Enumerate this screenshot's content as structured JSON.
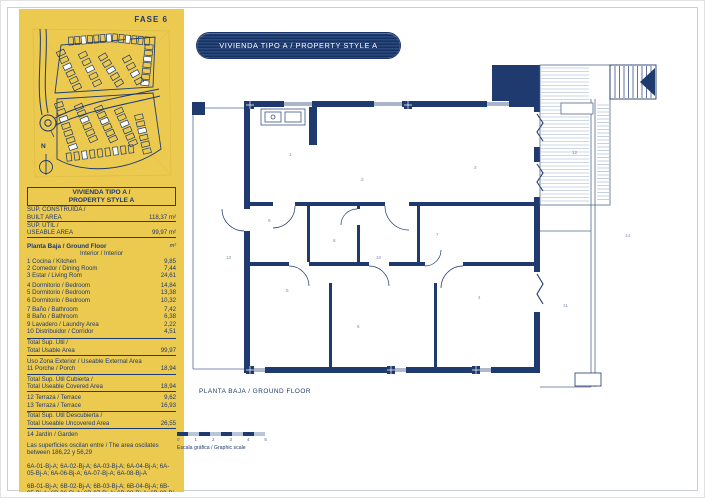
{
  "colors": {
    "navy": "#1f3a6e",
    "yellow": "#ecc94f",
    "deck_line": "#8fa3c4"
  },
  "sidebar": {
    "phase_label": "FASE 6",
    "north_label": "N",
    "table": {
      "title_line1": "VIVIENDA TIPO A /",
      "title_line2": "PROPERTY STYLE A",
      "area_rows": [
        {
          "label": "SUP. CONSTRUÍDA /",
          "value": ""
        },
        {
          "label": "BUILT AREA",
          "value": "118,37 m²"
        },
        {
          "label": "SUP. ÚTIL /",
          "value": ""
        },
        {
          "label": "USEABLE AREA",
          "value": "99,97 m²"
        }
      ],
      "floor_header": {
        "label": "Planta Baja / Ground Floor",
        "unit": "m²"
      },
      "interior_header": "Interior / Interior",
      "interior_rows": [
        {
          "label": "1 Cocina / Kitchen",
          "value": "9,85"
        },
        {
          "label": "2 Comedor / Dining Room",
          "value": "7,44"
        },
        {
          "label": "3 Estar / Living Rom",
          "value": "24,61"
        },
        {
          "label": "4 Dormitorio / Bedroom",
          "value": "14,84"
        },
        {
          "label": "5 Dormitorio / Bedroom",
          "value": "13,38"
        },
        {
          "label": "6 Dormitorio / Bedroom",
          "value": "10,32"
        },
        {
          "label": "7 Baño / Bathroom",
          "value": "7,42"
        },
        {
          "label": "8 Baño / Bathroom",
          "value": "6,38"
        },
        {
          "label": "9 Lavadero / Laundry Area",
          "value": "2,22"
        },
        {
          "label": "10 Distribuidor / Corridor",
          "value": "4,51"
        }
      ],
      "total_usable": {
        "label1": "Total Sup. Útil /",
        "label2": "Total Usable Area",
        "value": "99,97"
      },
      "external_header": "Uso Zona Exterior / Useable External Area",
      "porch_row": {
        "label": "11 Porche / Porch",
        "value": "18,94"
      },
      "total_covered": {
        "label1": "Total Sup. Útil Cubierta /",
        "label2": "Total Useable Covered Area",
        "value": "18,94"
      },
      "terrace_rows": [
        {
          "label": "12 Terraza / Terrace",
          "value": "9,62"
        },
        {
          "label": "13 Terraza / Terrace",
          "value": "16,93"
        }
      ],
      "total_uncovered": {
        "label1": "Total Sup. Útil Descubierta /",
        "label2": "Total Useable Uncovered Area",
        "value": "26,55"
      },
      "garden_row": "14 Jardín / Garden",
      "note": "Las superficies oscilan entre / The area oscilates between 186,22 y 56,29",
      "units_a": "6A-01-Bj-A; 6A-02-Bj-A; 6A-03-Bj-A; 6A-04-Bj-A; 6A-05-Bj-A; 6A-06-Bj-A; 6A-07-Bj-A; 6A-08-Bj-A",
      "units_b": "6B-01-Bj-A; 6B-02-Bj-A; 6B-03-Bj-A; 6B-04-Bj-A; 6B-05-Bj-A; 6B-06-Bj-A; 6B-07-Bj-A; 6B-08-Bj-A; 6B-09-Bj-A; 6B-10-Bj-A; 6B-11-Bj-A"
    }
  },
  "header": {
    "title": "VIVIENDA TIPO A / PROPERTY STYLE A"
  },
  "plan": {
    "caption": "PLANTA BAJA / GROUND FLOOR",
    "scale_label": "Escala gráfica / Graphic scale",
    "scale_ticks": [
      "0",
      "1",
      "2",
      "3",
      "4",
      "5"
    ],
    "room_numbers": [
      {
        "n": "1",
        "x": 100,
        "y": 99
      },
      {
        "n": "2",
        "x": 172,
        "y": 124
      },
      {
        "n": "3",
        "x": 285,
        "y": 112
      },
      {
        "n": "4",
        "x": 289,
        "y": 242
      },
      {
        "n": "5",
        "x": 97,
        "y": 235
      },
      {
        "n": "6",
        "x": 168,
        "y": 271
      },
      {
        "n": "7",
        "x": 247,
        "y": 179
      },
      {
        "n": "8",
        "x": 144,
        "y": 185
      },
      {
        "n": "9",
        "x": 79,
        "y": 165
      },
      {
        "n": "10",
        "x": 187,
        "y": 202
      },
      {
        "n": "11",
        "x": 374,
        "y": 250
      },
      {
        "n": "12",
        "x": 383,
        "y": 97
      },
      {
        "n": "13",
        "x": 37,
        "y": 202
      },
      {
        "n": "14",
        "x": 436,
        "y": 180
      }
    ]
  }
}
